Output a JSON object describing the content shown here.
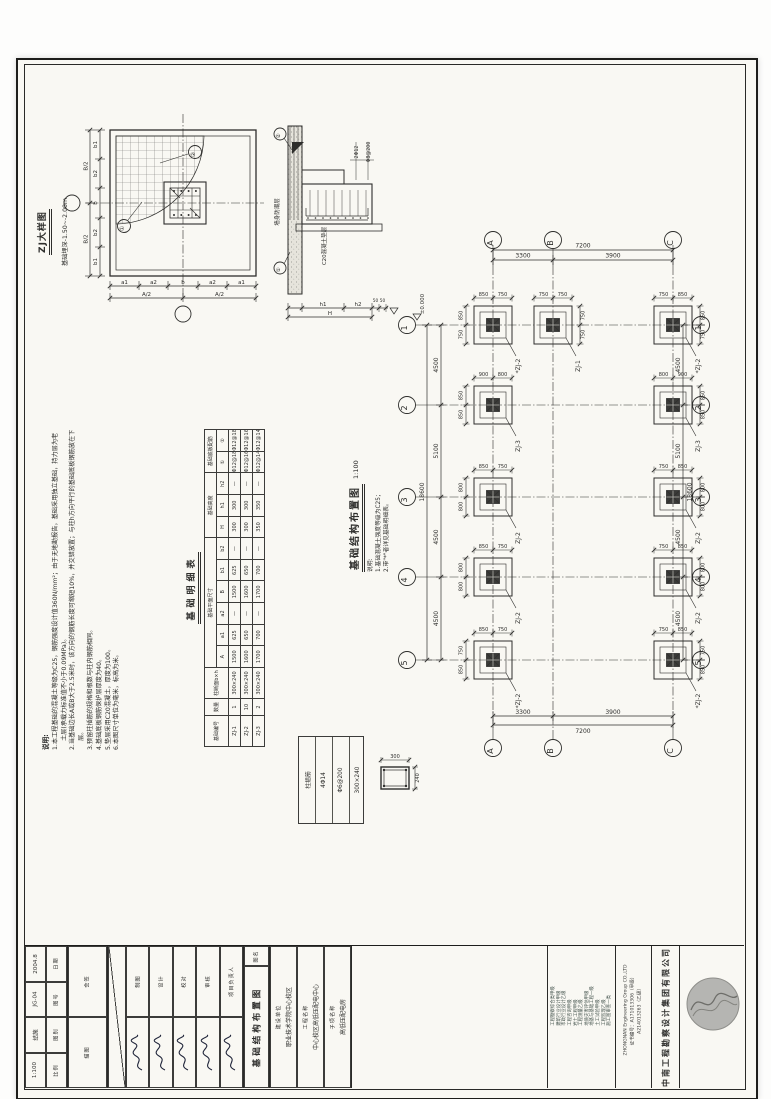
{
  "colors": {
    "paper": "#f9f8f3",
    "line": "#2e2e2c",
    "column_fill": "#3a3a38",
    "logo_gray": "#b5b5b2"
  },
  "detail_zj": {
    "title": "ZJ大样图",
    "subtitle": "基础埋深-1.50~-2.00m",
    "dims_bottom": [
      "a1",
      "a2",
      "b",
      "a2",
      "a1"
    ],
    "dims_bottom_total": [
      "A/2",
      "A/2"
    ],
    "dims_left": [
      "b1",
      "b2",
      "b",
      "b2",
      "b1"
    ],
    "dims_left_total": [
      "B/2",
      "B/2"
    ],
    "rebar_marks": [
      "①",
      "②"
    ]
  },
  "detail_section": {
    "wall_label": "墙身防潮层",
    "bedding_label": "C20混凝土垫层",
    "callout1": "2Φ12",
    "callout2": "Φ8@200",
    "dims_bottom": [
      "h1",
      "h2"
    ],
    "dim_total": "H",
    "dims_stub": [
      "50",
      "50"
    ],
    "marks": [
      "①",
      "②"
    ]
  },
  "plan": {
    "title": "基础结构布置图",
    "scale": "1:100",
    "notes_title": "说明:",
    "notes": [
      "1.基础混凝土强度等级为C25；",
      "2.带\"*\"者详见基础明细表。"
    ],
    "elevation": "±0.000",
    "axes_cols": [
      "A",
      "B",
      "C"
    ],
    "axes_rows": [
      "1",
      "2",
      "3",
      "4",
      "5"
    ],
    "col_dims": [
      "3300",
      "3900"
    ],
    "col_total": "7200",
    "row_dims": [
      "4500",
      "5100",
      "4500",
      "4500"
    ],
    "row_total": "18600",
    "footings": [
      {
        "r": 0,
        "c": 0,
        "label": "*ZJ-2",
        "top": [
          "850",
          "750"
        ],
        "side": [
          "850",
          "750"
        ],
        "sideOn": "left"
      },
      {
        "r": 0,
        "c": 1,
        "label": "ZJ-1",
        "top": [
          "750",
          "750"
        ],
        "side": [
          "750",
          "750"
        ],
        "sideOn": "right"
      },
      {
        "r": 0,
        "c": 2,
        "label": "*ZJ-2",
        "top": [
          "750",
          "850"
        ],
        "side": [
          "850",
          "750"
        ],
        "sideOn": "right"
      },
      {
        "r": 1,
        "c": 0,
        "label": "ZJ-3",
        "top": [
          "900",
          "800"
        ],
        "side": [
          "850",
          "850"
        ],
        "sideOn": "left"
      },
      {
        "r": 1,
        "c": 2,
        "label": "ZJ-3",
        "top": [
          "800",
          "900"
        ],
        "side": [
          "850",
          "850"
        ],
        "sideOn": "right"
      },
      {
        "r": 2,
        "c": 0,
        "label": "ZJ-2",
        "top": [
          "850",
          "750"
        ],
        "side": [
          "800",
          "800"
        ],
        "sideOn": "left"
      },
      {
        "r": 2,
        "c": 2,
        "label": "ZJ-2",
        "top": [
          "750",
          "850"
        ],
        "side": [
          "800",
          "800"
        ],
        "sideOn": "right"
      },
      {
        "r": 3,
        "c": 0,
        "label": "ZJ-2",
        "top": [
          "850",
          "750"
        ],
        "side": [
          "800",
          "800"
        ],
        "sideOn": "left"
      },
      {
        "r": 3,
        "c": 2,
        "label": "ZJ-2",
        "top": [
          "750",
          "850"
        ],
        "side": [
          "800",
          "800"
        ],
        "sideOn": "right"
      },
      {
        "r": 4,
        "c": 0,
        "label": "*ZJ-2",
        "top": [
          "850",
          "750"
        ],
        "side": [
          "750",
          "850"
        ],
        "sideOn": "left"
      },
      {
        "r": 4,
        "c": 2,
        "label": "*ZJ-2",
        "top": [
          "750",
          "850"
        ],
        "side": [
          "750",
          "850"
        ],
        "sideOn": "right"
      }
    ]
  },
  "schedule": {
    "title": "基础明细表",
    "head1": [
      "基础编号",
      "数量",
      "柱断面b×h",
      "基础平面尺寸",
      "基础高度",
      "基础底板配筋"
    ],
    "head2": [
      "A",
      "a1",
      "a2",
      "B",
      "b1",
      "b2",
      "H",
      "h1",
      "h2",
      "①",
      "②"
    ],
    "rows": [
      [
        "ZJ-1",
        "1",
        "300×240",
        "1500",
        "625",
        "—",
        "1500",
        "625",
        "—",
        "300",
        "300",
        "—",
        "Φ12@180",
        "Φ12@180"
      ],
      [
        "ZJ-2",
        "10",
        "300×240",
        "1600",
        "650",
        "—",
        "1600",
        "650",
        "—",
        "300",
        "300",
        "—",
        "Φ12@160",
        "Φ12@160"
      ],
      [
        "ZJ-3",
        "2",
        "300×240",
        "1700",
        "700",
        "—",
        "1700",
        "700",
        "—",
        "350",
        "350",
        "—",
        "Φ12@140",
        "Φ12@140"
      ]
    ]
  },
  "notes_main": {
    "title": "说明:",
    "items": [
      "1.本工程基础的混凝土等级为C25，钢筋强度设计值360N/mm²；由于无地勘报告，基础采用独立基础，持力层为老土层(承载力标准值不小于0.09MPa)。",
      "2.当基础边长A或B大于2.5米时，该方向的钢筋长度可缩短10%，并交错放置；与柱h方向平行的基础底板钢筋放在下层。",
      "3.预留柱插筋的规格和根数与柱内钢筋相同。",
      "4.基础底板钢筋保护层厚度为40。",
      "5.垫层采用C20混凝土，厚度为100。",
      "6.本图尺寸单位为毫米，标高为米。"
    ]
  },
  "legend": {
    "lines": [
      "柱插筋",
      "4Φ14",
      "Φ6@200",
      "300×240"
    ],
    "square_w": "300",
    "square_h": "240"
  },
  "titleblock": {
    "fields": [
      {
        "label": "日期",
        "value": "2004.8"
      },
      {
        "label": "图号",
        "value": "JG-04"
      },
      {
        "label": "图别",
        "value": "结施"
      },
      {
        "label": "比例",
        "value": "1:100"
      }
    ],
    "aux": [
      "会签",
      "描图"
    ],
    "signatures": [
      {
        "role": "制图"
      },
      {
        "role": "设计"
      },
      {
        "role": "校对"
      },
      {
        "role": "审核"
      },
      {
        "role": "项目负责人"
      }
    ],
    "drawing_name_label": "图名",
    "drawing_name": "基础结构布置图",
    "projects": [
      {
        "label": "建设单位",
        "value": "职业技术学院中心校区"
      },
      {
        "label": "工程名称",
        "value": "中心校区高低压配电中心"
      },
      {
        "label": "子项名称",
        "value": "高低压配电房"
      }
    ],
    "qualifications": [
      "工程勘察综合类甲级",
      "建筑行业设计甲级",
      "市政行业设计乙级",
      "工程咨询甲级",
      "岩土工程甲级",
      "工程测量乙级",
      "地质灾害评估甲级",
      "地基与基础工程一级",
      "土工试验甲级",
      "工程监理乙级",
      "施工图审查一类"
    ],
    "company_en": "ZHONGNAN Engineering Group CO.,LTD",
    "cert1": "证书编号：A171013306（甲级）",
    "cert2": "A214013263（乙级）",
    "company_cn": "中南工程勘察设计集团有限公司"
  }
}
